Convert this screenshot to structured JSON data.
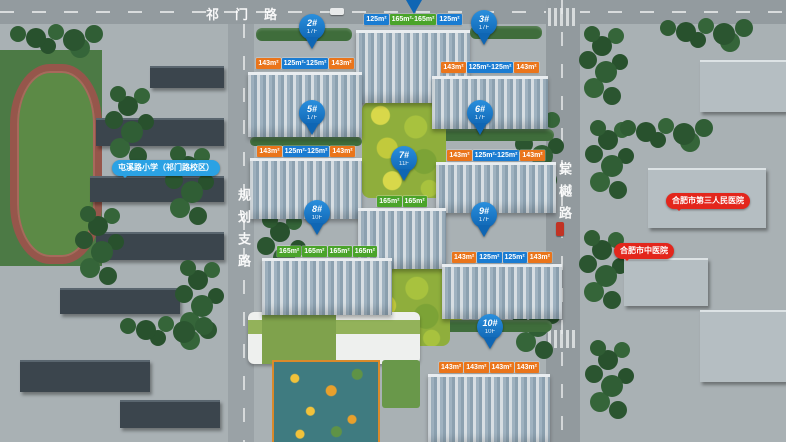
{
  "roads": {
    "top": "祁门路",
    "left": "规划支路",
    "right": "棠樾路"
  },
  "landmarks": {
    "school": "屯溪路小学（祁门路校区）",
    "hospital_third": "合肥市第三人民医院",
    "hospital_tcm": "合肥市中医院"
  },
  "buildings": [
    {
      "pin": "",
      "sub": "",
      "tags": [
        {
          "t": "125m²",
          "c": "blue"
        },
        {
          "t": "165m²·165m²",
          "c": "green"
        },
        {
          "t": "125m²",
          "c": "blue"
        }
      ]
    },
    {
      "pin": "2#",
      "sub": "17F",
      "tags": [
        {
          "t": "143m²",
          "c": "orange"
        },
        {
          "t": "125m²·125m²",
          "c": "blue"
        },
        {
          "t": "143m²",
          "c": "orange"
        }
      ]
    },
    {
      "pin": "3#",
      "sub": "17F",
      "tags": [
        {
          "t": "143m²",
          "c": "orange"
        },
        {
          "t": "125m²·125m²",
          "c": "blue"
        },
        {
          "t": "143m²",
          "c": "orange"
        }
      ]
    },
    {
      "pin": "5#",
      "sub": "17F",
      "tags": [
        {
          "t": "143m²",
          "c": "orange"
        },
        {
          "t": "125m²·125m²",
          "c": "blue"
        },
        {
          "t": "143m²",
          "c": "orange"
        }
      ]
    },
    {
      "pin": "6#",
      "sub": "17F",
      "tags": [
        {
          "t": "143m²",
          "c": "orange"
        },
        {
          "t": "125m²·125m²",
          "c": "blue"
        },
        {
          "t": "143m²",
          "c": "orange"
        }
      ]
    },
    {
      "pin": "7#",
      "sub": "11F",
      "tags": [
        {
          "t": "165m²",
          "c": "green"
        },
        {
          "t": "165m²",
          "c": "green"
        }
      ]
    },
    {
      "pin": "8#",
      "sub": "10F",
      "tags": [
        {
          "t": "165m²",
          "c": "green"
        },
        {
          "t": "165m²",
          "c": "green"
        },
        {
          "t": "165m²",
          "c": "green"
        },
        {
          "t": "165m²",
          "c": "green"
        }
      ]
    },
    {
      "pin": "9#",
      "sub": "17F",
      "tags": [
        {
          "t": "143m²",
          "c": "orange"
        },
        {
          "t": "125m²",
          "c": "blue"
        },
        {
          "t": "125m²",
          "c": "blue"
        },
        {
          "t": "143m²",
          "c": "orange"
        }
      ]
    },
    {
      "pin": "10#",
      "sub": "10F",
      "tags": [
        {
          "t": "143m²",
          "c": "orange"
        },
        {
          "t": "143m²",
          "c": "orange"
        },
        {
          "t": "143m²",
          "c": "orange"
        },
        {
          "t": "143m²",
          "c": "orange"
        }
      ]
    }
  ],
  "colors": {
    "tag_blue": "#1a7cd2",
    "tag_orange": "#ea751b",
    "tag_green": "#4aa42a",
    "pin_blue": "#0f66b4",
    "bubble_blue": "#2ba2e4",
    "bubble_red": "#e3261c"
  }
}
